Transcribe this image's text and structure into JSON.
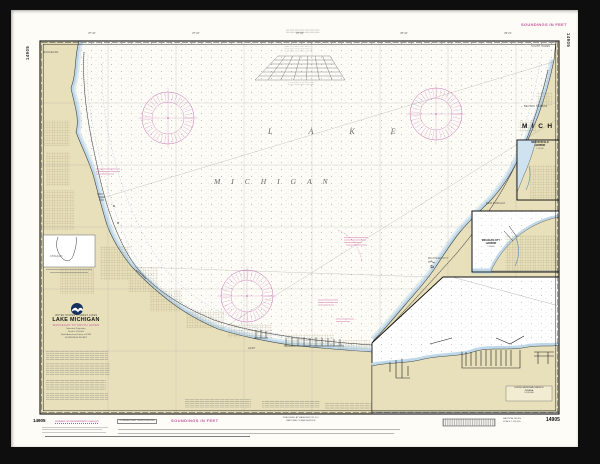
{
  "artwork": {
    "kind": "Framed NOAA nautical chart print",
    "chart_number": "14905"
  },
  "colors": {
    "frame": "#0e0e0e",
    "paper": "#fdfcf7",
    "land": "#e8e0ba",
    "shallow_water": "#bed8e9",
    "magenta": "#c4549e",
    "ink": "#1b1b1b"
  },
  "map": {
    "lake_word_1": "LAKE",
    "lake_word_2": "MICHIGAN",
    "state_label": "MICH",
    "longitude_ticks": [
      "87°40'",
      "87°20'",
      "87°00'",
      "86°40'",
      "86°20'"
    ],
    "shore_labels": {
      "waukegan": "WAUKEGAN",
      "chicago": "CHICAGO",
      "gary": "GARY",
      "michigan_city": "MICHIGAN CITY",
      "new_buffalo": "NEW BUFFALO",
      "benton_harbor": "BENTON HARBOR",
      "south_haven": "SOUTH HAVEN"
    }
  },
  "title_block": {
    "header": "UNITED STATES — GREAT LAKES",
    "title": "LAKE MICHIGAN",
    "subtitle": "WAUKEGAN TO SOUTH HAVEN",
    "detail_lines": [
      "Mercator Projection",
      "Scale 1:120,000",
      "North American Datum of 1983",
      "SOUNDINGS IN FEET"
    ]
  },
  "insets": {
    "new_buffalo": {
      "title": "NEW BUFFALO",
      "title2": "HARBOR",
      "scale": "1:15,000"
    },
    "michigan_city": {
      "title": "MICHIGAN CITY",
      "title2": "HARBOR",
      "scale": "1:15,000"
    },
    "south_shore": {
      "label1": "BURNS WATERWAY HARBOR",
      "label2": "INDIANA",
      "label3": "1:120,000"
    }
  },
  "margins": {
    "side_number_left": "14905",
    "side_number_right": "14905",
    "top_right_note": "SOUNDINGS IN FEET",
    "bottom": {
      "number_left": "14905",
      "magenta_note": "Updates at nauticalcharts.noaa.gov",
      "boxed_note": "CORRECTED THROUGH NM",
      "soundings_note": "SOUNDINGS IN FEET",
      "imprint_line1": "PUBLISHED AT WASHINGTON, D.C.",
      "imprint_line2": "NATIONAL OCEAN SERVICE",
      "scale_note_line1": "NAUTICAL MILES",
      "scale_note_line2": "SCALE 1:120,000",
      "number_right": "14905"
    }
  }
}
